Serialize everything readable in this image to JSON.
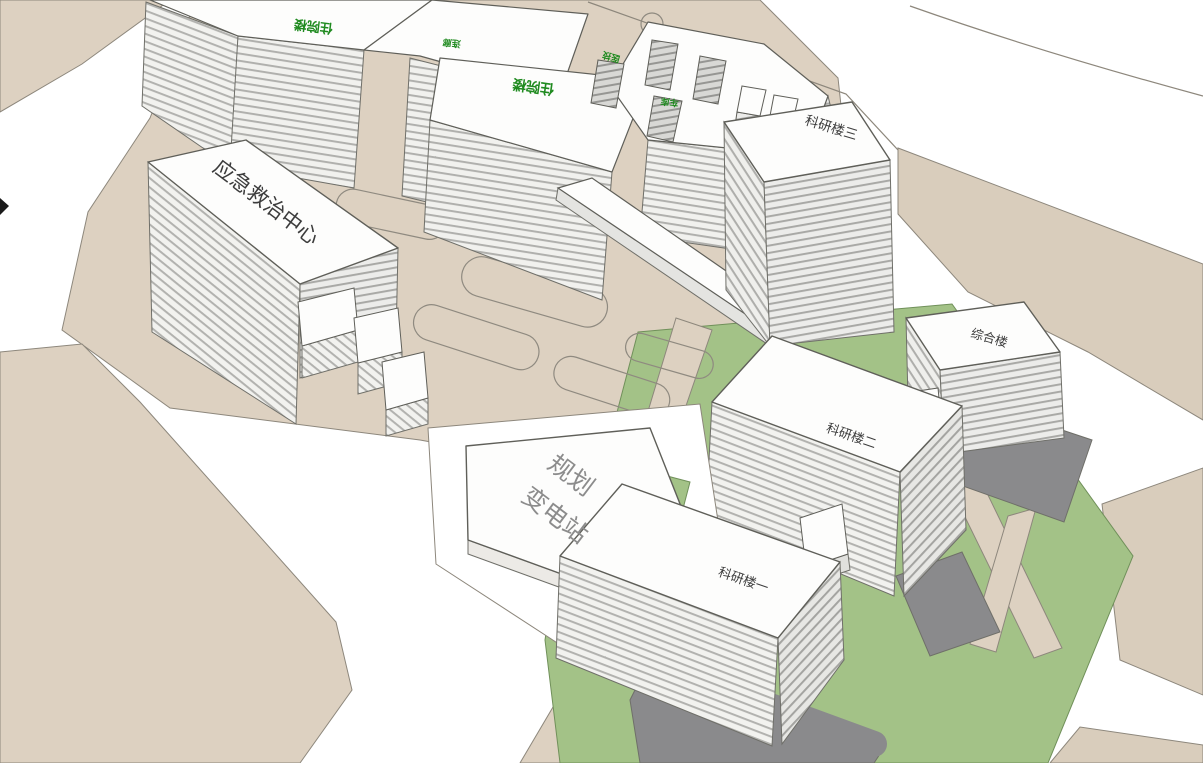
{
  "scene": {
    "buildings": {
      "emergency_center": "应急救治中心",
      "research_tower_3": "科研楼三",
      "research_building_2": "科研楼二",
      "research_building_1": "科研楼一",
      "comprehensive": "综合楼",
      "substation_line1": "规划",
      "substation_line2": "变电站",
      "inpatient_wing_west": "住院楼",
      "inpatient_wing_center": "住院楼"
    },
    "annotations": {
      "corridor": "连廊",
      "medtech": "医技",
      "garage": "车库"
    },
    "colors": {
      "road_white": "#ffffff",
      "ground_tan": "#ddd1c1",
      "lawn_green": "#a3c287",
      "paving_gray": "#8a8a8c",
      "facade_light": "#f2f2ef",
      "roof_white": "#fdfdfc",
      "outline_gray": "#6f6f69",
      "label_green": "#1f8a1f",
      "label_dark": "#3c3c3c",
      "label_gray": "#8c8c8c"
    }
  }
}
